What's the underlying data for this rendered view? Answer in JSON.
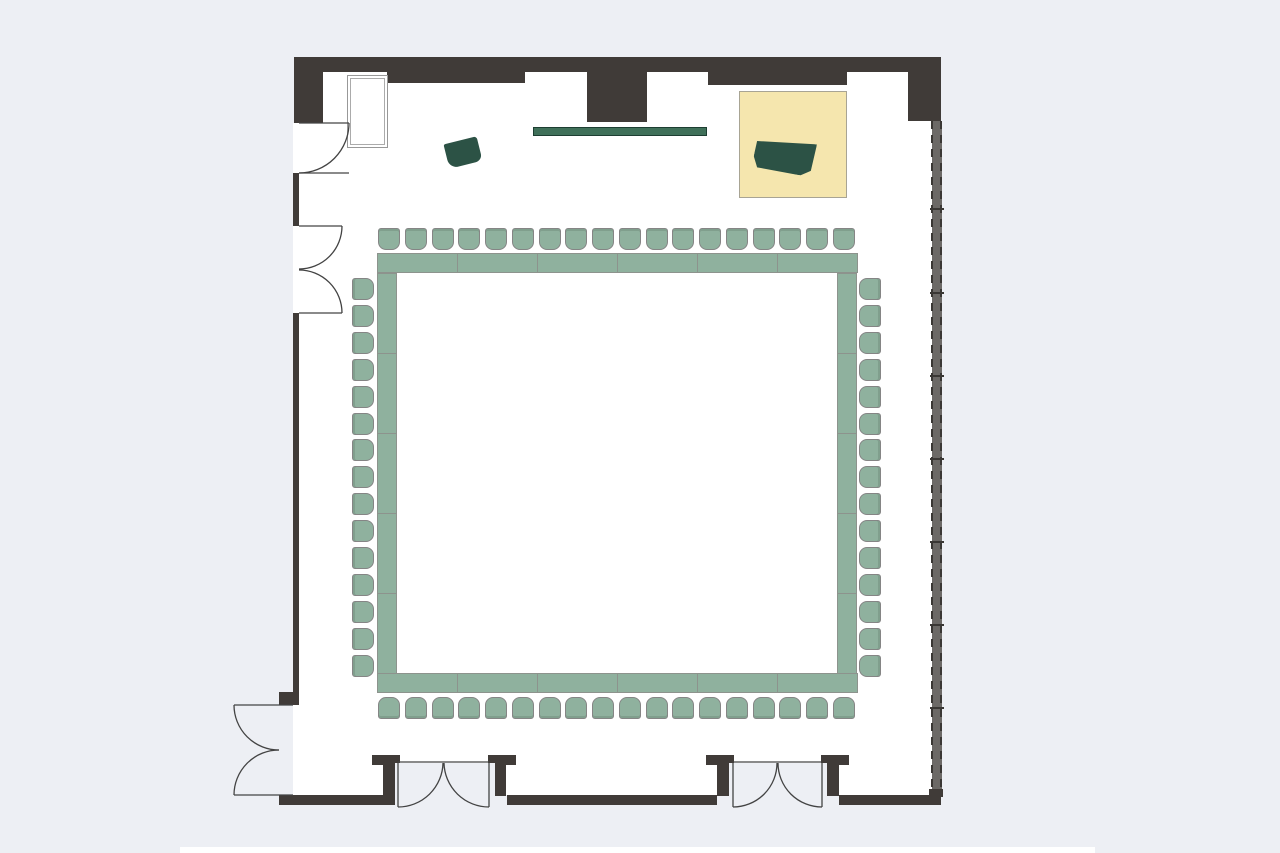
{
  "meta": {
    "kind": "floor-plan",
    "description": "Meeting room floor plan with hollow-square conference table setup, stage with grand piano, lectern, wall screen, storage cabinet, window wall and five door openings",
    "canvas": {
      "width": 1280,
      "height": 853
    }
  },
  "colors": {
    "background": "#edeff4",
    "room_fill": "#ffffff",
    "wall": "#403b38",
    "furniture_green": "#8fb19e",
    "furniture_green_border": "#8d938d",
    "chair_border": "#858585",
    "accent_dark_green": "#2c5245",
    "screen_green": "#3f7059",
    "stage_fill": "#f5e6ae",
    "stage_border": "#a8a494",
    "window_strip": "#6c6966",
    "window_dash": "#3a3734",
    "door_line": "#434343"
  },
  "inventory": {
    "conference_ring": {
      "layout": "hollow-square",
      "table_segments": 22,
      "chairs_total": 66,
      "chairs_per_side": {
        "top": 18,
        "bottom": 18,
        "left": 15,
        "right": 15
      }
    },
    "stage_platform": {
      "items": [
        "grand-piano"
      ]
    },
    "lectern": 1,
    "wall_screen": 1,
    "storage_cabinet": 1,
    "window_wall": {
      "side": "east",
      "panels": 8
    },
    "doors": [
      {
        "id": "left-upper",
        "type": "single-swing-in"
      },
      {
        "id": "left-middle",
        "type": "double-swing-in"
      },
      {
        "id": "left-lower",
        "type": "double-swing-out"
      },
      {
        "id": "bottom-west",
        "type": "double-entry-recessed"
      },
      {
        "id": "bottom-east",
        "type": "double-entry-recessed"
      }
    ]
  },
  "layout": {
    "tables": [
      {
        "side": "top",
        "x": 377,
        "y": 253,
        "length": 480,
        "thickness": 20,
        "segments": 6,
        "dir": "h"
      },
      {
        "side": "bottom",
        "x": 377,
        "y": 673,
        "length": 480,
        "thickness": 20,
        "segments": 6,
        "dir": "h"
      },
      {
        "side": "left",
        "x": 377,
        "y": 273,
        "length": 400,
        "thickness": 20,
        "segments": 5,
        "dir": "v"
      },
      {
        "side": "right",
        "x": 837,
        "y": 273,
        "length": 400,
        "thickness": 20,
        "segments": 5,
        "dir": "v"
      }
    ],
    "chair_rows": [
      {
        "side": "top",
        "count": 18,
        "x": 378,
        "y": 228,
        "pitch": 26.75,
        "size": 22
      },
      {
        "side": "bottom",
        "count": 18,
        "x": 378,
        "y": 697,
        "pitch": 26.75,
        "size": 22
      },
      {
        "side": "left",
        "count": 15,
        "x": 352,
        "y": 278,
        "pitch": 26.9,
        "size": 22
      },
      {
        "side": "right",
        "count": 15,
        "x": 859,
        "y": 278,
        "pitch": 26.9,
        "size": 22
      }
    ],
    "window_wall": {
      "x": 932,
      "y": 121,
      "w": 10,
      "h": 674,
      "ticks": [
        208,
        292,
        375,
        458,
        541,
        624,
        707
      ]
    }
  }
}
